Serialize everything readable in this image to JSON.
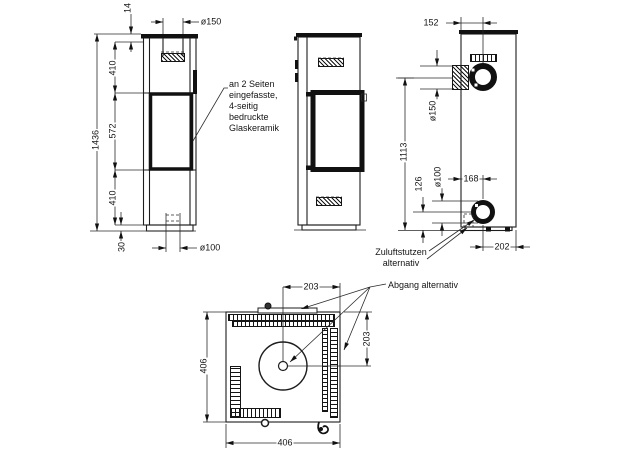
{
  "front_view": {
    "dims": {
      "top_plate": "14",
      "flue": "ø150",
      "upper": "410",
      "total": "1436",
      "middle": "572",
      "lower": "410",
      "base": "30",
      "inlet": "ø100"
    },
    "glass_note": {
      "line1": "an 2 Seiten",
      "line2": "eingefasste,",
      "line3": "4-seitig",
      "line4": "bedruckte",
      "line5": "Glaskeramik"
    }
  },
  "side_view": {
    "dims": {
      "flue_center_height": "1113"
    }
  },
  "back_view": {
    "dims": {
      "flue_offset": "152",
      "flue": "ø150",
      "inlet": "ø100",
      "inlet_height": "126",
      "inlet_offset": "168",
      "edge_offset": "202"
    },
    "air_inlet_note": {
      "line1": "Zuluftstutzen",
      "line2": "alternativ"
    },
    "outlet_note": "Abgang alternativ"
  },
  "top_view": {
    "dims": {
      "flue_offset_x": "203",
      "flue_offset_y": "203",
      "width": "406",
      "depth": "406"
    }
  }
}
